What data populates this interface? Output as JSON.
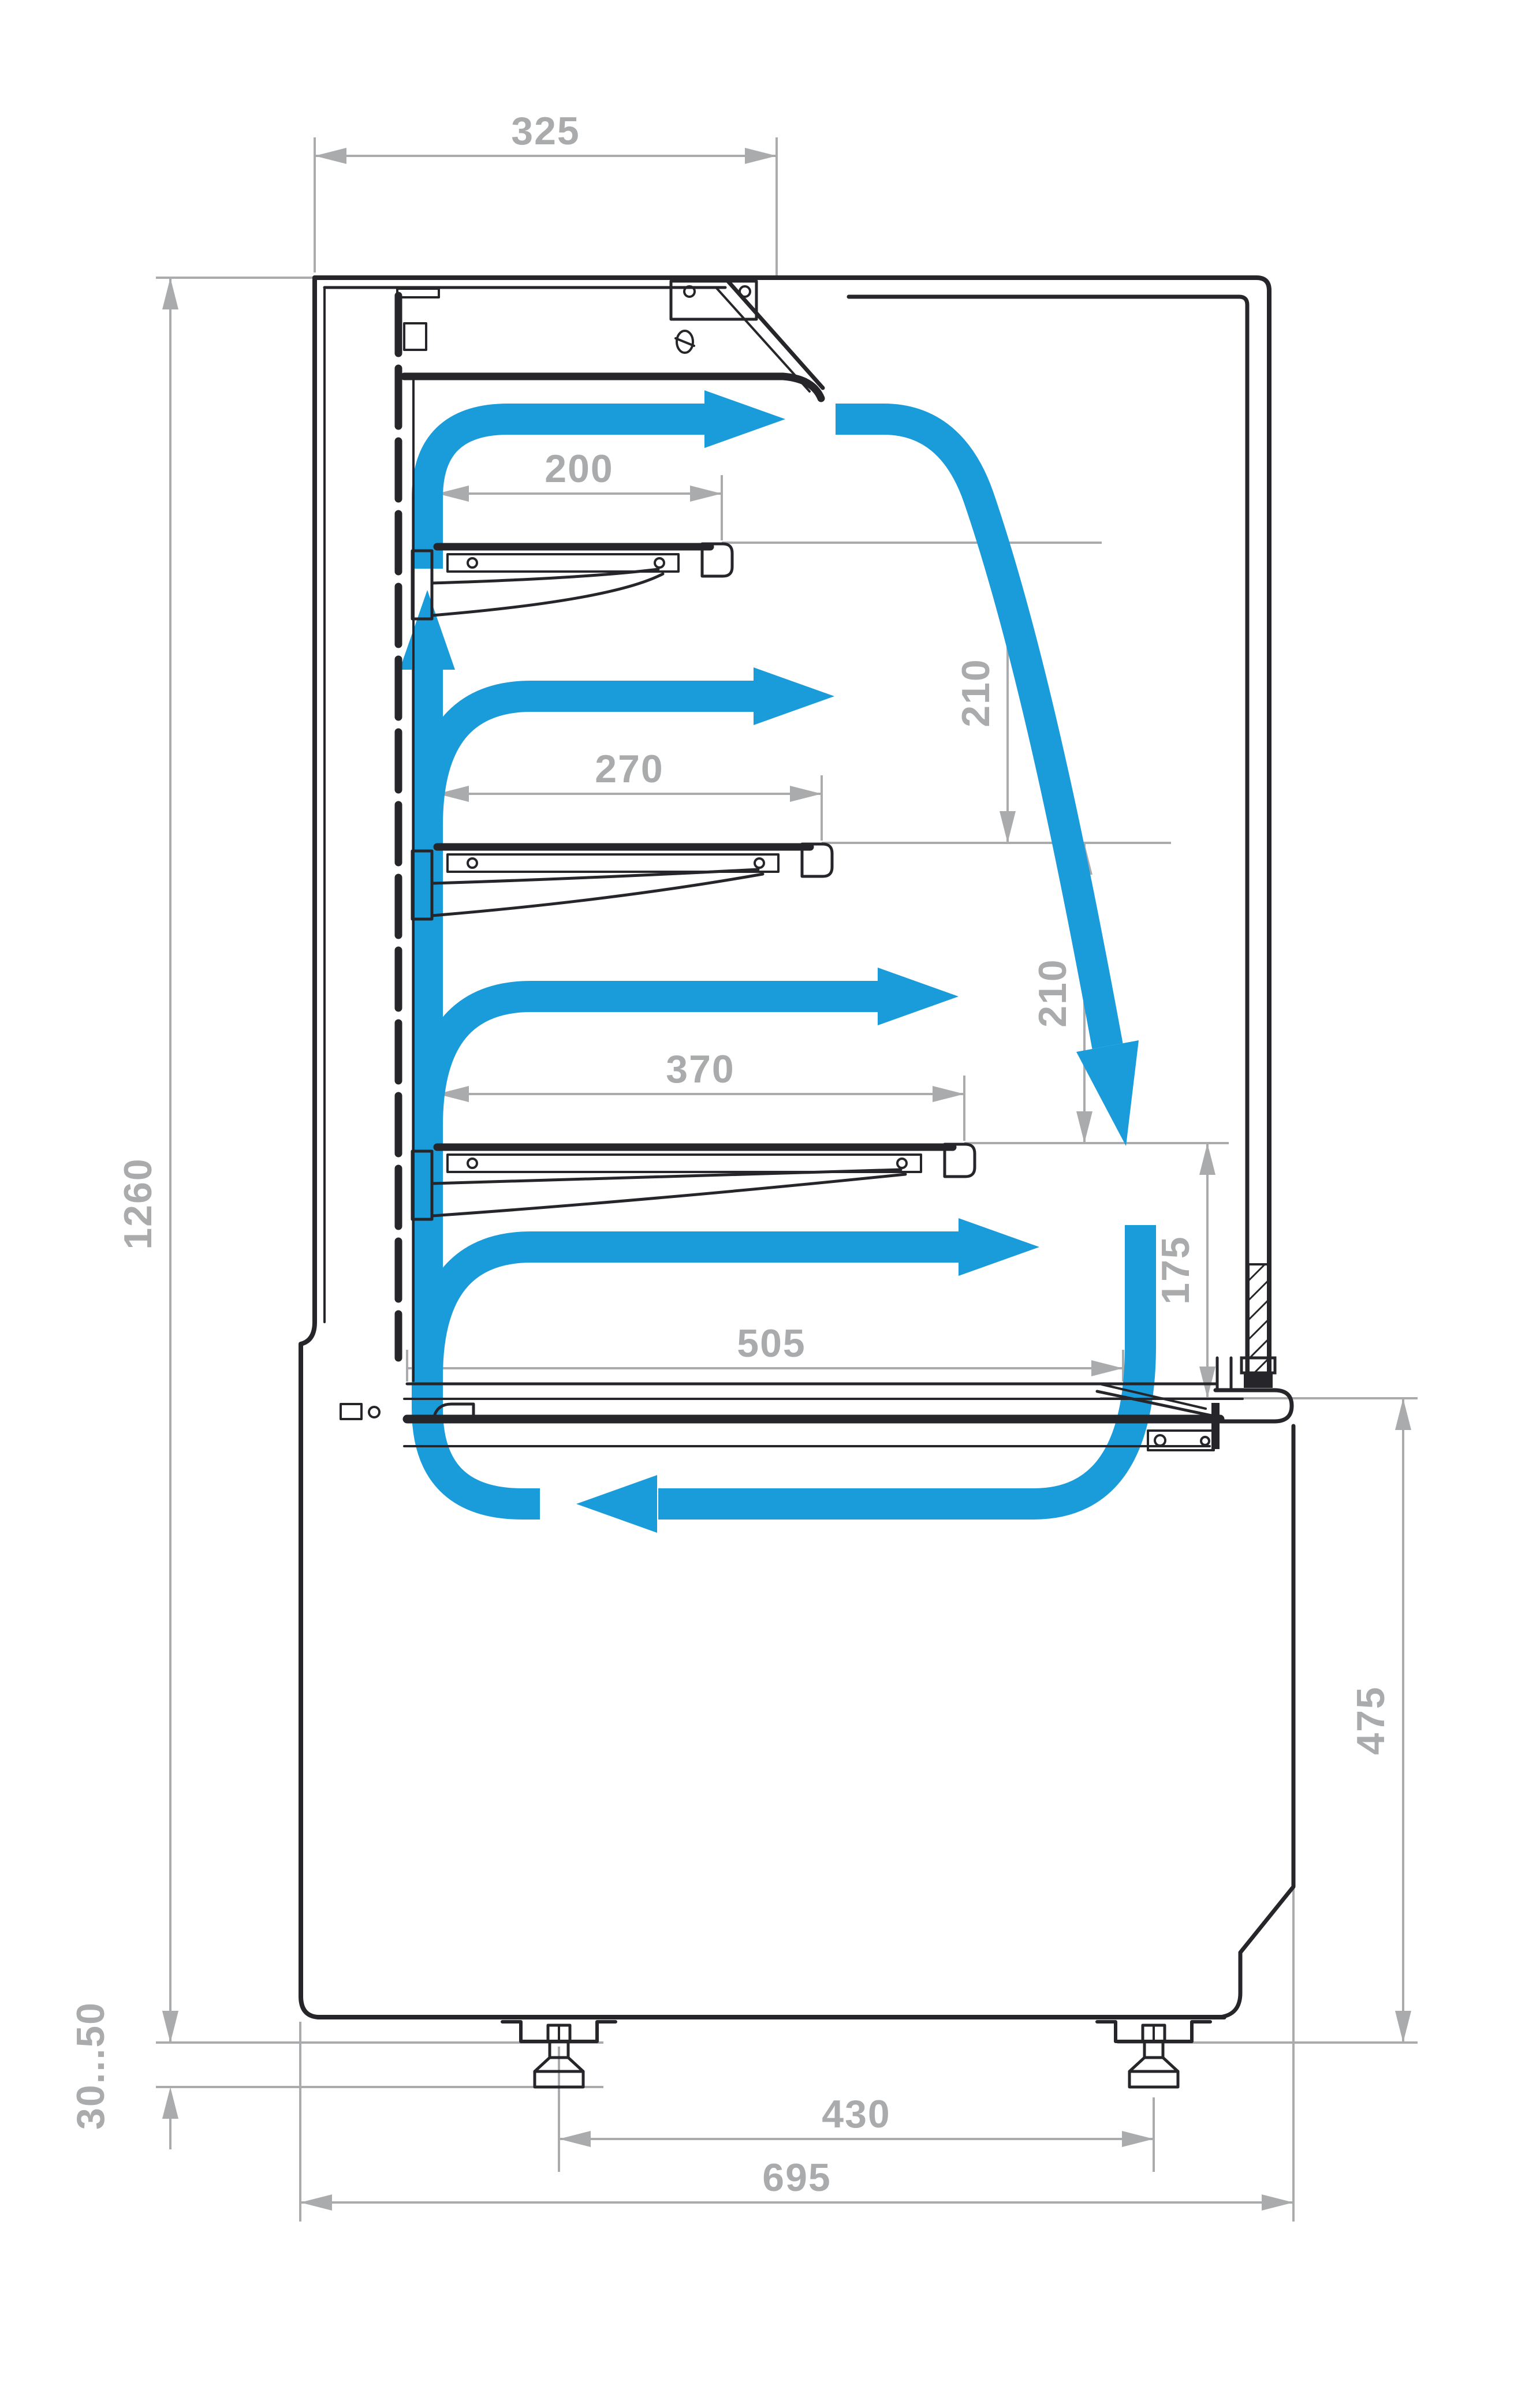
{
  "figure": {
    "description": "Side cross-section airflow and dimension diagram of a refrigerated display case",
    "colors": {
      "airflow": "#1A9CDB",
      "dimension": "#A9ABAD",
      "outline": "#26262A",
      "background": "#ffffff"
    },
    "dimensions_mm": {
      "canopy_depth": "325",
      "shelf_top_depth": "200",
      "shelf_middle_depth": "270",
      "shelf_lower_depth": "370",
      "well_depth": "505",
      "shelf_gap_upper": "210",
      "shelf_gap_lower": "210",
      "front_opening_height": "175",
      "display_height": "1260",
      "base_height": "475",
      "leg_height_range": "30...50",
      "leg_spacing": "430",
      "overall_depth": "695"
    }
  }
}
